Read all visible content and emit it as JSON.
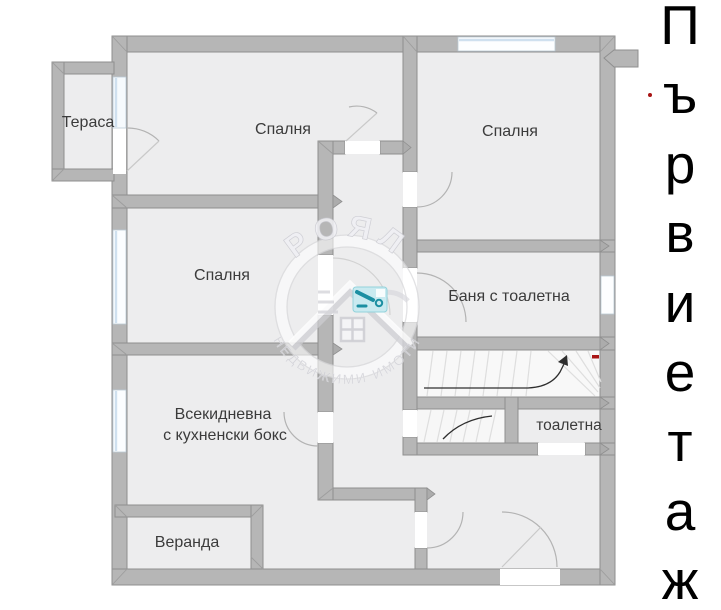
{
  "type": "floor_plan",
  "floor_title": {
    "text": "Първи етаж",
    "letters": [
      "П",
      "ъ",
      "р",
      "в",
      "и",
      "е",
      "т",
      "а",
      "ж"
    ]
  },
  "rooms": {
    "terrace": "Тераса",
    "bedroom1": "Спалня",
    "bedroom2": "Спалня",
    "bedroom3": "Спалня",
    "bath": "Баня с тоалетна",
    "living_line1": "Всекидневна",
    "living_line2": "с кухненски бокс",
    "veranda": "Веранда",
    "toilet": "тоалетна"
  },
  "watermark": {
    "brand": "РОЯЛ",
    "subtitle": "НЕДВИЖИМИ ИМОТИ"
  },
  "colors": {
    "wall": "#b6b6b6",
    "wall_edge": "#8f8f8f",
    "floor": "#ededee",
    "window_blue": "#cfe0ef",
    "accent_teal": "#1b8fa2",
    "red_mark": "#a81414",
    "label": "#3b3b3b"
  }
}
